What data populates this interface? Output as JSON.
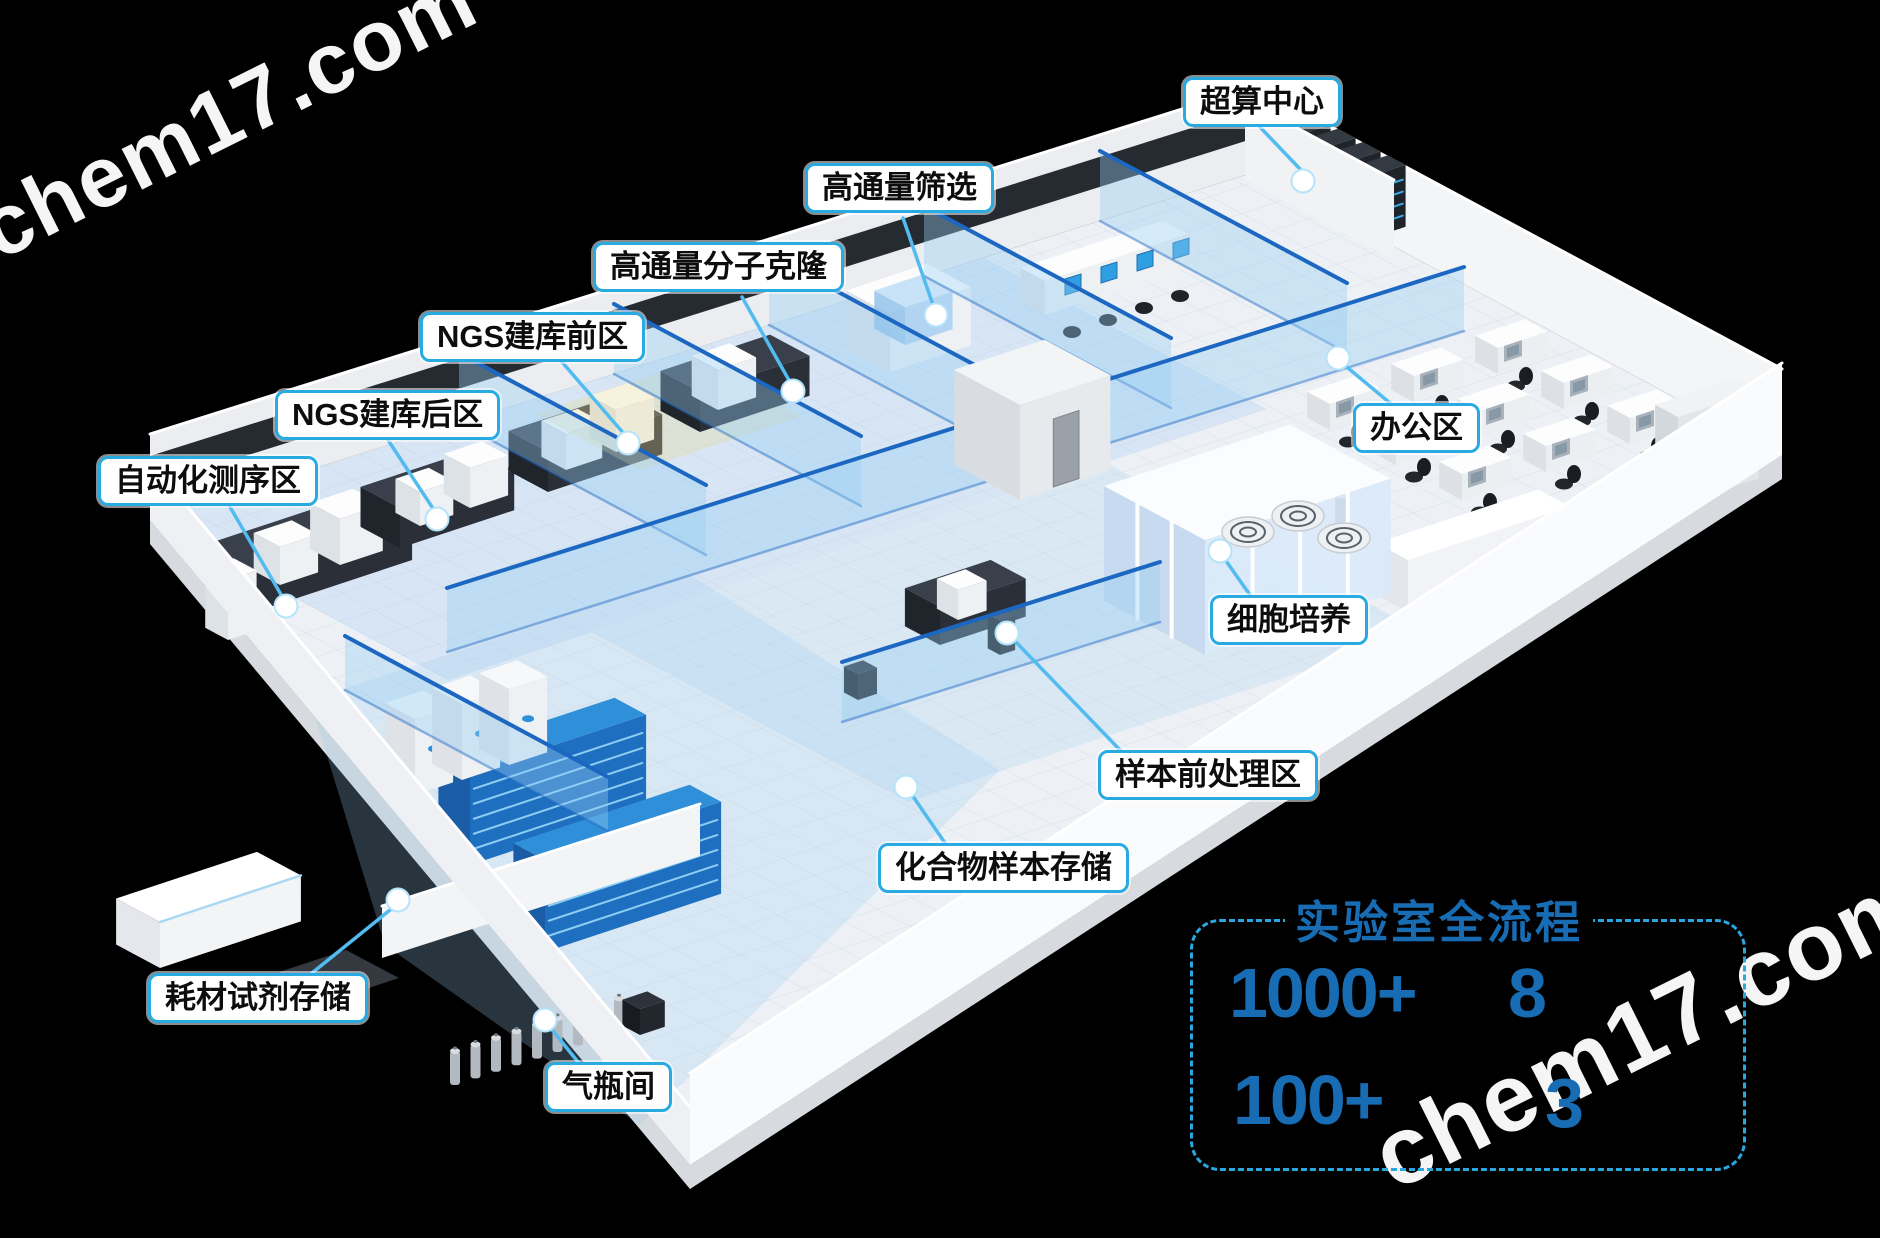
{
  "watermark": {
    "text": "chem17.com"
  },
  "room_labels": [
    {
      "id": "supercomputing-center",
      "label": "超算中心"
    },
    {
      "id": "high-throughput-screening",
      "label": "高通量筛选"
    },
    {
      "id": "high-throughput-molecular-cloning",
      "label": "高通量分子克隆"
    },
    {
      "id": "ngs-library-prep-front",
      "label": "NGS建库前区"
    },
    {
      "id": "ngs-library-prep-back",
      "label": "NGS建库后区"
    },
    {
      "id": "automated-sequencing",
      "label": "自动化测序区"
    },
    {
      "id": "office-area",
      "label": "办公区"
    },
    {
      "id": "cell-culture",
      "label": "细胞培养"
    },
    {
      "id": "sample-pretreatment",
      "label": "样本前处理区"
    },
    {
      "id": "compound-sample-storage",
      "label": "化合物样本存储"
    },
    {
      "id": "consumables-reagent-storage",
      "label": "耗材试剂存储"
    },
    {
      "id": "gas-cylinder-room",
      "label": "气瓶间"
    }
  ],
  "stats_panel": {
    "title": "实验室全流程",
    "stats": [
      {
        "value": "1000+"
      },
      {
        "value": "8"
      },
      {
        "value": "100+"
      },
      {
        "value": "3"
      }
    ]
  },
  "colors": {
    "label_border_blue": "#29abe2",
    "stats_blue": "#176cb4",
    "dashed_border_blue": "#2aa7e0",
    "leader_line_blue": "#52bbf0",
    "glass_beam_blue": "#1c67c1",
    "rack_blue": "#2f8fd8",
    "background": "#000000"
  }
}
